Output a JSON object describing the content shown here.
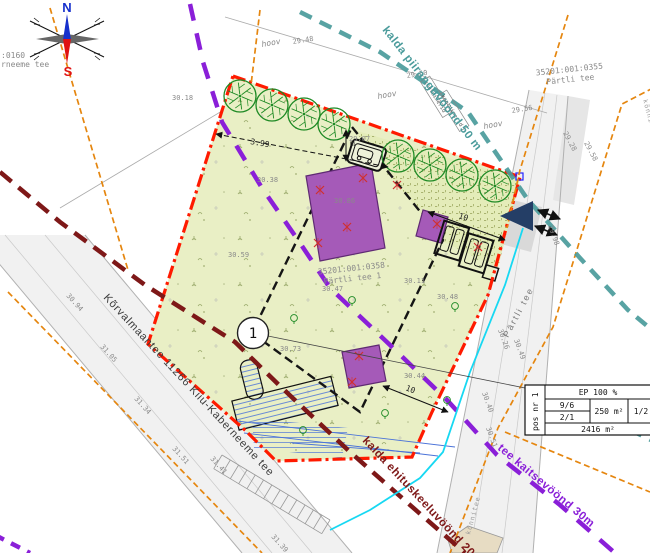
{
  "page": {
    "width": 650,
    "height": 553,
    "background": "#ffffff"
  },
  "colors": {
    "plot_fill": "#e9efc5",
    "paving_fill": "#e4ecb9",
    "boundary_red": "#ff1a00",
    "envelope_black": "#151515",
    "building_purple": "#a55ab8",
    "building_border": "#5f2a73",
    "tree_green": "#1e8a24",
    "teal_line": "#4a9b9b",
    "purple_line": "#8a1fd8",
    "maroon_line": "#7e1818",
    "orange_line": "#e5860f",
    "cyan_line": "#17d8f2",
    "blue_hatch": "#4a72d8",
    "road_fill": "#f1f1f1",
    "road_edge": "#b0b0b0",
    "label_gray": "#8a8a8a",
    "navy_arrow": "#243e66",
    "north_blue": "#1630cc",
    "south_red": "#e01212",
    "tan_fill": "#e7dcc3",
    "xmark_red": "#d03030"
  },
  "compass": {
    "north": "N",
    "south": "S"
  },
  "zone_labels": {
    "kalda_piirang": "kalda piiranguvöönd 50 m",
    "tee_kaitse": "tee kaitsevöönd 30m",
    "kalda_keeld": "kalda ehituskeeluvöönd 20m"
  },
  "roads": {
    "main": "Kõrvalmaantee 11266 Kiiu-Kaberneeme tee",
    "partli": "Pärtli tee",
    "sidewalk1": "kõnnitee",
    "sidewalk2": "kõnnitee"
  },
  "parcels": {
    "p0355_code": "35201:001:0355",
    "p0355_name": "Pärtli tee",
    "p0358_code": "35201:001:0358",
    "p0358_name": "Pärtli tee 1",
    "left_code": ":0160",
    "left_name": "rneeme tee"
  },
  "site_texts": {
    "hoov1": "hoov",
    "hoov2": "hoov",
    "hoov3": "hoov",
    "containers1": "konteinerid",
    "containers2": "konteinerid",
    "pos_marker": "1"
  },
  "dimensions": {
    "offset": "3.99",
    "d10a": "10",
    "d10b": "10",
    "m": "m"
  },
  "table": {
    "pos": "pos nr 1",
    "ep": "EP 100 %",
    "c_9_6": "9/6",
    "c_2_1": "2/1",
    "area_building": "250 m²",
    "ratio": "1/2",
    "area_plot": "2416 m²"
  },
  "elevations": [
    {
      "t": "30.18",
      "x": 172,
      "y": 100,
      "r": 0
    },
    {
      "t": "29.48",
      "x": 293,
      "y": 44,
      "r": -9
    },
    {
      "t": "29.50",
      "x": 407,
      "y": 78,
      "r": -9
    },
    {
      "t": "29.56",
      "x": 512,
      "y": 113,
      "r": -9
    },
    {
      "t": "29.07",
      "x": 349,
      "y": 141,
      "r": 0
    },
    {
      "t": "30.38",
      "x": 257,
      "y": 182,
      "r": 0
    },
    {
      "t": "30.59",
      "x": 228,
      "y": 257,
      "r": 0
    },
    {
      "t": "30.86",
      "x": 334,
      "y": 203,
      "r": 0
    },
    {
      "t": "30.11",
      "x": 404,
      "y": 283,
      "r": 0
    },
    {
      "t": "30.47",
      "x": 322,
      "y": 291,
      "r": 0
    },
    {
      "t": "30.48",
      "x": 437,
      "y": 299,
      "r": 0
    },
    {
      "t": "30.73",
      "x": 280,
      "y": 351,
      "r": 0
    },
    {
      "t": "30.44",
      "x": 404,
      "y": 378,
      "r": 0
    },
    {
      "t": "30.94",
      "x": 66,
      "y": 296,
      "r": 48
    },
    {
      "t": "31.05",
      "x": 100,
      "y": 347,
      "r": 48
    },
    {
      "t": "31.34",
      "x": 134,
      "y": 399,
      "r": 48
    },
    {
      "t": "31.51",
      "x": 172,
      "y": 449,
      "r": 48
    },
    {
      "t": "31.41",
      "x": 210,
      "y": 459,
      "r": 48
    },
    {
      "t": "31.39",
      "x": 271,
      "y": 537,
      "r": 48
    },
    {
      "t": "30.26",
      "x": 498,
      "y": 330,
      "r": 70
    },
    {
      "t": "30.49",
      "x": 514,
      "y": 340,
      "r": 70
    },
    {
      "t": "30.40",
      "x": 482,
      "y": 393,
      "r": 70
    },
    {
      "t": "30.51",
      "x": 486,
      "y": 428,
      "r": 70
    },
    {
      "t": "29.98",
      "x": 548,
      "y": 226,
      "r": 70
    },
    {
      "t": "29.28",
      "x": 563,
      "y": 133,
      "r": 62
    },
    {
      "t": "29.58",
      "x": 584,
      "y": 143,
      "r": 62
    }
  ],
  "trees": [
    {
      "x": 240,
      "y": 96
    },
    {
      "x": 272,
      "y": 105
    },
    {
      "x": 304,
      "y": 114
    },
    {
      "x": 334,
      "y": 124
    },
    {
      "x": 398,
      "y": 156
    },
    {
      "x": 430,
      "y": 165
    },
    {
      "x": 462,
      "y": 175
    },
    {
      "x": 495,
      "y": 186
    }
  ],
  "bushes": [
    {
      "x": 294,
      "y": 318
    },
    {
      "x": 385,
      "y": 413
    },
    {
      "x": 447,
      "y": 400
    },
    {
      "x": 303,
      "y": 430
    },
    {
      "x": 455,
      "y": 306
    },
    {
      "x": 352,
      "y": 300
    }
  ],
  "xmarks": [
    {
      "x": 320,
      "y": 190
    },
    {
      "x": 347,
      "y": 227
    },
    {
      "x": 318,
      "y": 243
    },
    {
      "x": 437,
      "y": 224
    },
    {
      "x": 359,
      "y": 356
    },
    {
      "x": 352,
      "y": 382
    },
    {
      "x": 363,
      "y": 178
    },
    {
      "x": 397,
      "y": 185
    },
    {
      "x": 478,
      "y": 247
    }
  ]
}
